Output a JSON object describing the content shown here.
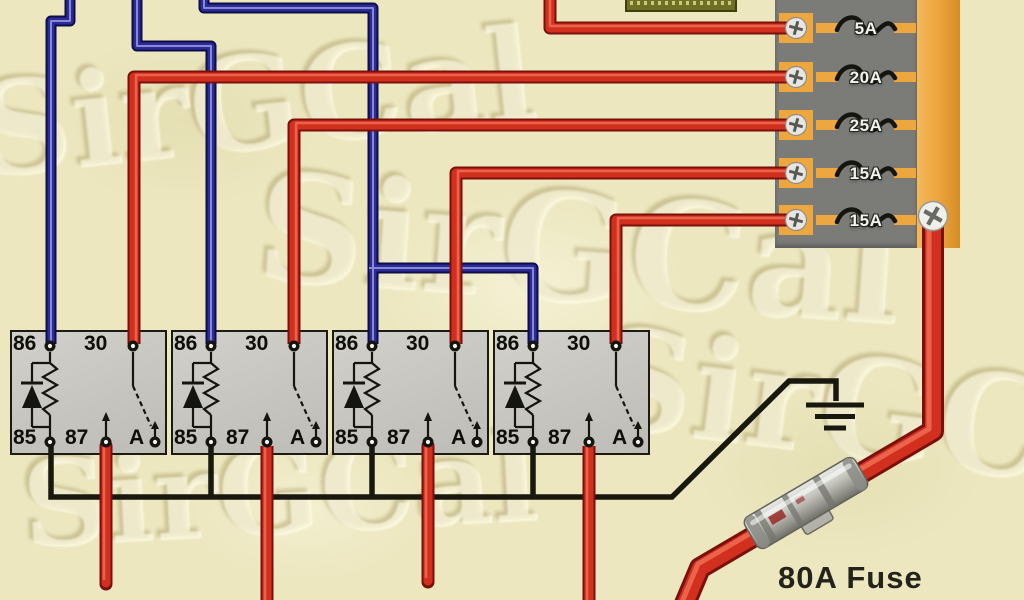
{
  "title": "Automotive relay and fuse panel wiring diagram",
  "watermark": {
    "text": "SirGCal"
  },
  "fusebox": {
    "fuses": [
      {
        "label": "5A"
      },
      {
        "label": "20A"
      },
      {
        "label": "25A"
      },
      {
        "label": "15A"
      },
      {
        "label": "15A"
      }
    ]
  },
  "relays": [
    {
      "t86": "86",
      "t30": "30",
      "t85": "85",
      "t87": "87",
      "tA": "A"
    },
    {
      "t86": "86",
      "t30": "30",
      "t85": "85",
      "t87": "87",
      "tA": "A"
    },
    {
      "t86": "86",
      "t30": "30",
      "t85": "85",
      "t87": "87",
      "tA": "A"
    },
    {
      "t86": "86",
      "t30": "30",
      "t85": "85",
      "t87": "87",
      "tA": "A"
    }
  ],
  "main_fuse": {
    "label": "80A Fuse"
  },
  "colors": {
    "background": "#ece7bf",
    "wire_red": "#d2301f",
    "wire_blue": "#2b2b9c",
    "wire_black": "#18180f",
    "fusebox_gray": "#7b7b78",
    "fusebox_orange": "#eea63f",
    "relay_fill": "#c7c5bf"
  }
}
